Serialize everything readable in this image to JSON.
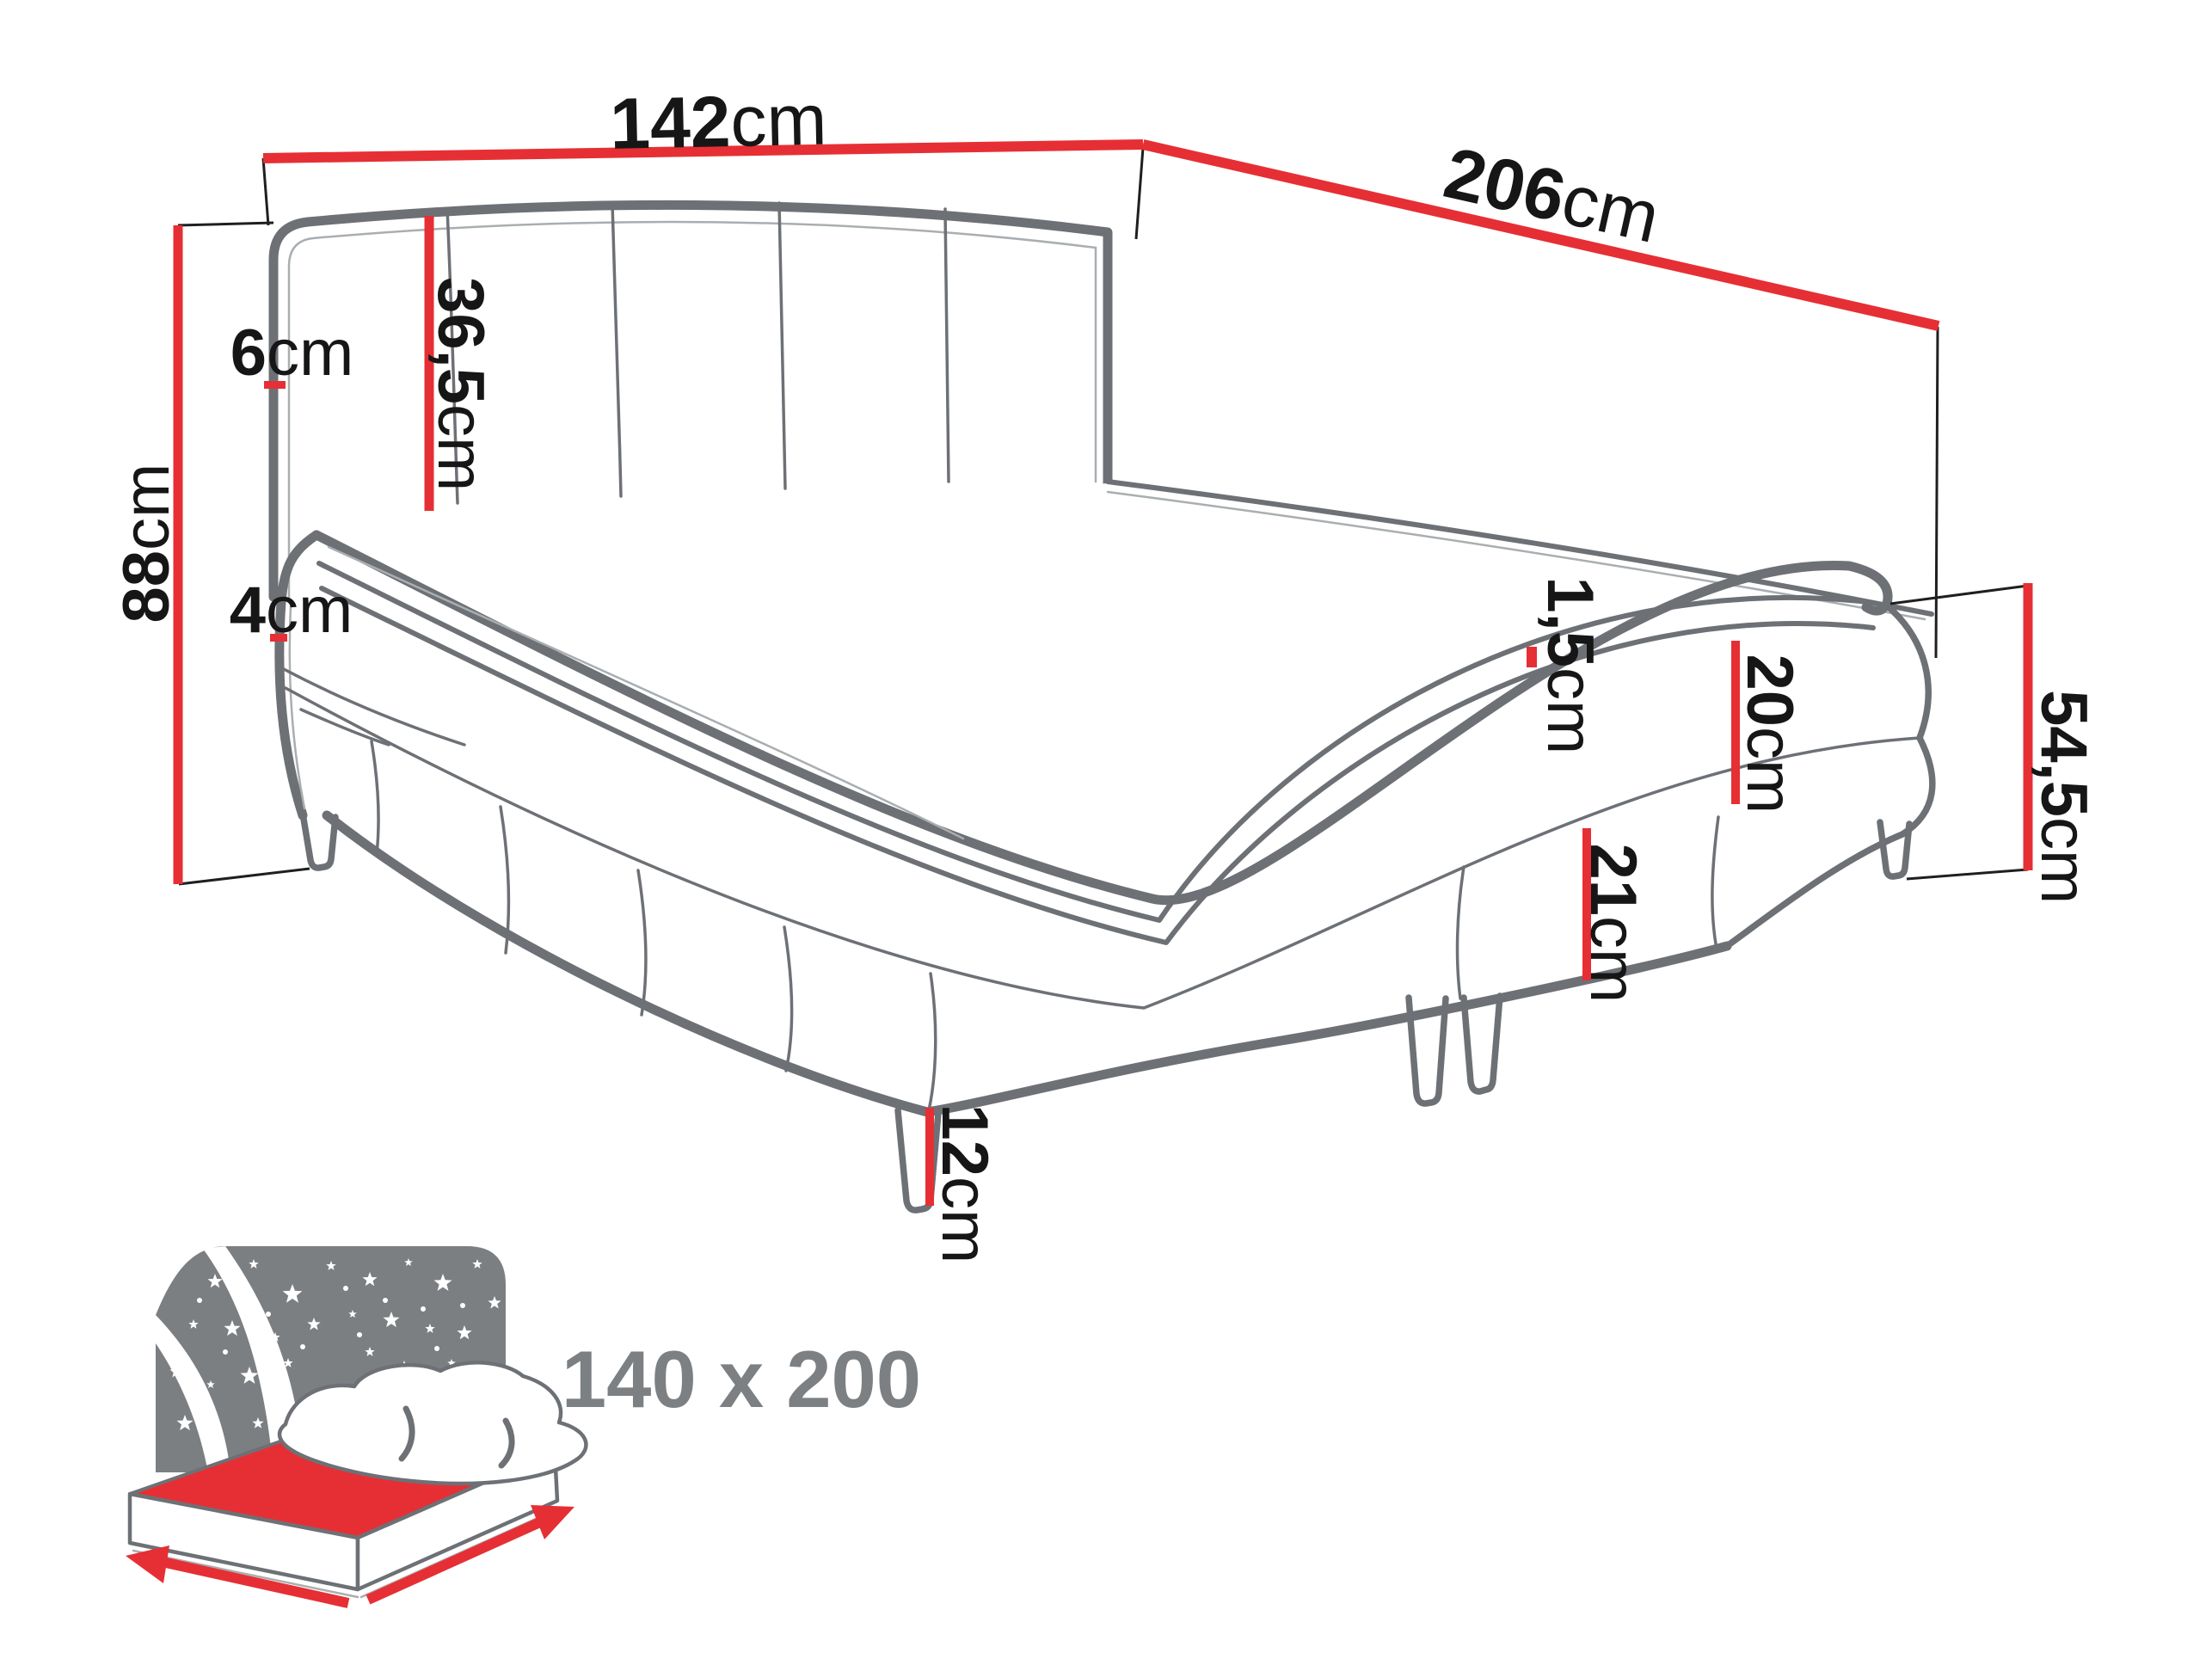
{
  "title": "boxspring bed dimensions diagram",
  "dims": {
    "width": {
      "value": "142",
      "unit": "cm"
    },
    "length": {
      "value": "206",
      "unit": "cm"
    },
    "height": {
      "value": "88",
      "unit": "cm"
    },
    "headboard_depth": {
      "value": "6",
      "unit": "cm"
    },
    "headboard_above": {
      "value": "36,5",
      "unit": "cm"
    },
    "topper": {
      "value": "4",
      "unit": "cm"
    },
    "seam": {
      "value": "1,5",
      "unit": "cm"
    },
    "upper_box": {
      "value": "20",
      "unit": "cm"
    },
    "lower_box": {
      "value": "21",
      "unit": "cm"
    },
    "side_height": {
      "value": "54,5",
      "unit": "cm"
    },
    "leg": {
      "value": "12",
      "unit": "cm"
    }
  },
  "footer": {
    "size_label": "140 x 200"
  },
  "colors": {
    "accent_red": "#e62f34",
    "drawing_gray": "#6d7176",
    "light_gray": "#a9aeb1",
    "icon_gray": "#7c7f82",
    "label_black": "#161616",
    "size_label_gray": "#7d8083",
    "background": "#ffffff"
  }
}
